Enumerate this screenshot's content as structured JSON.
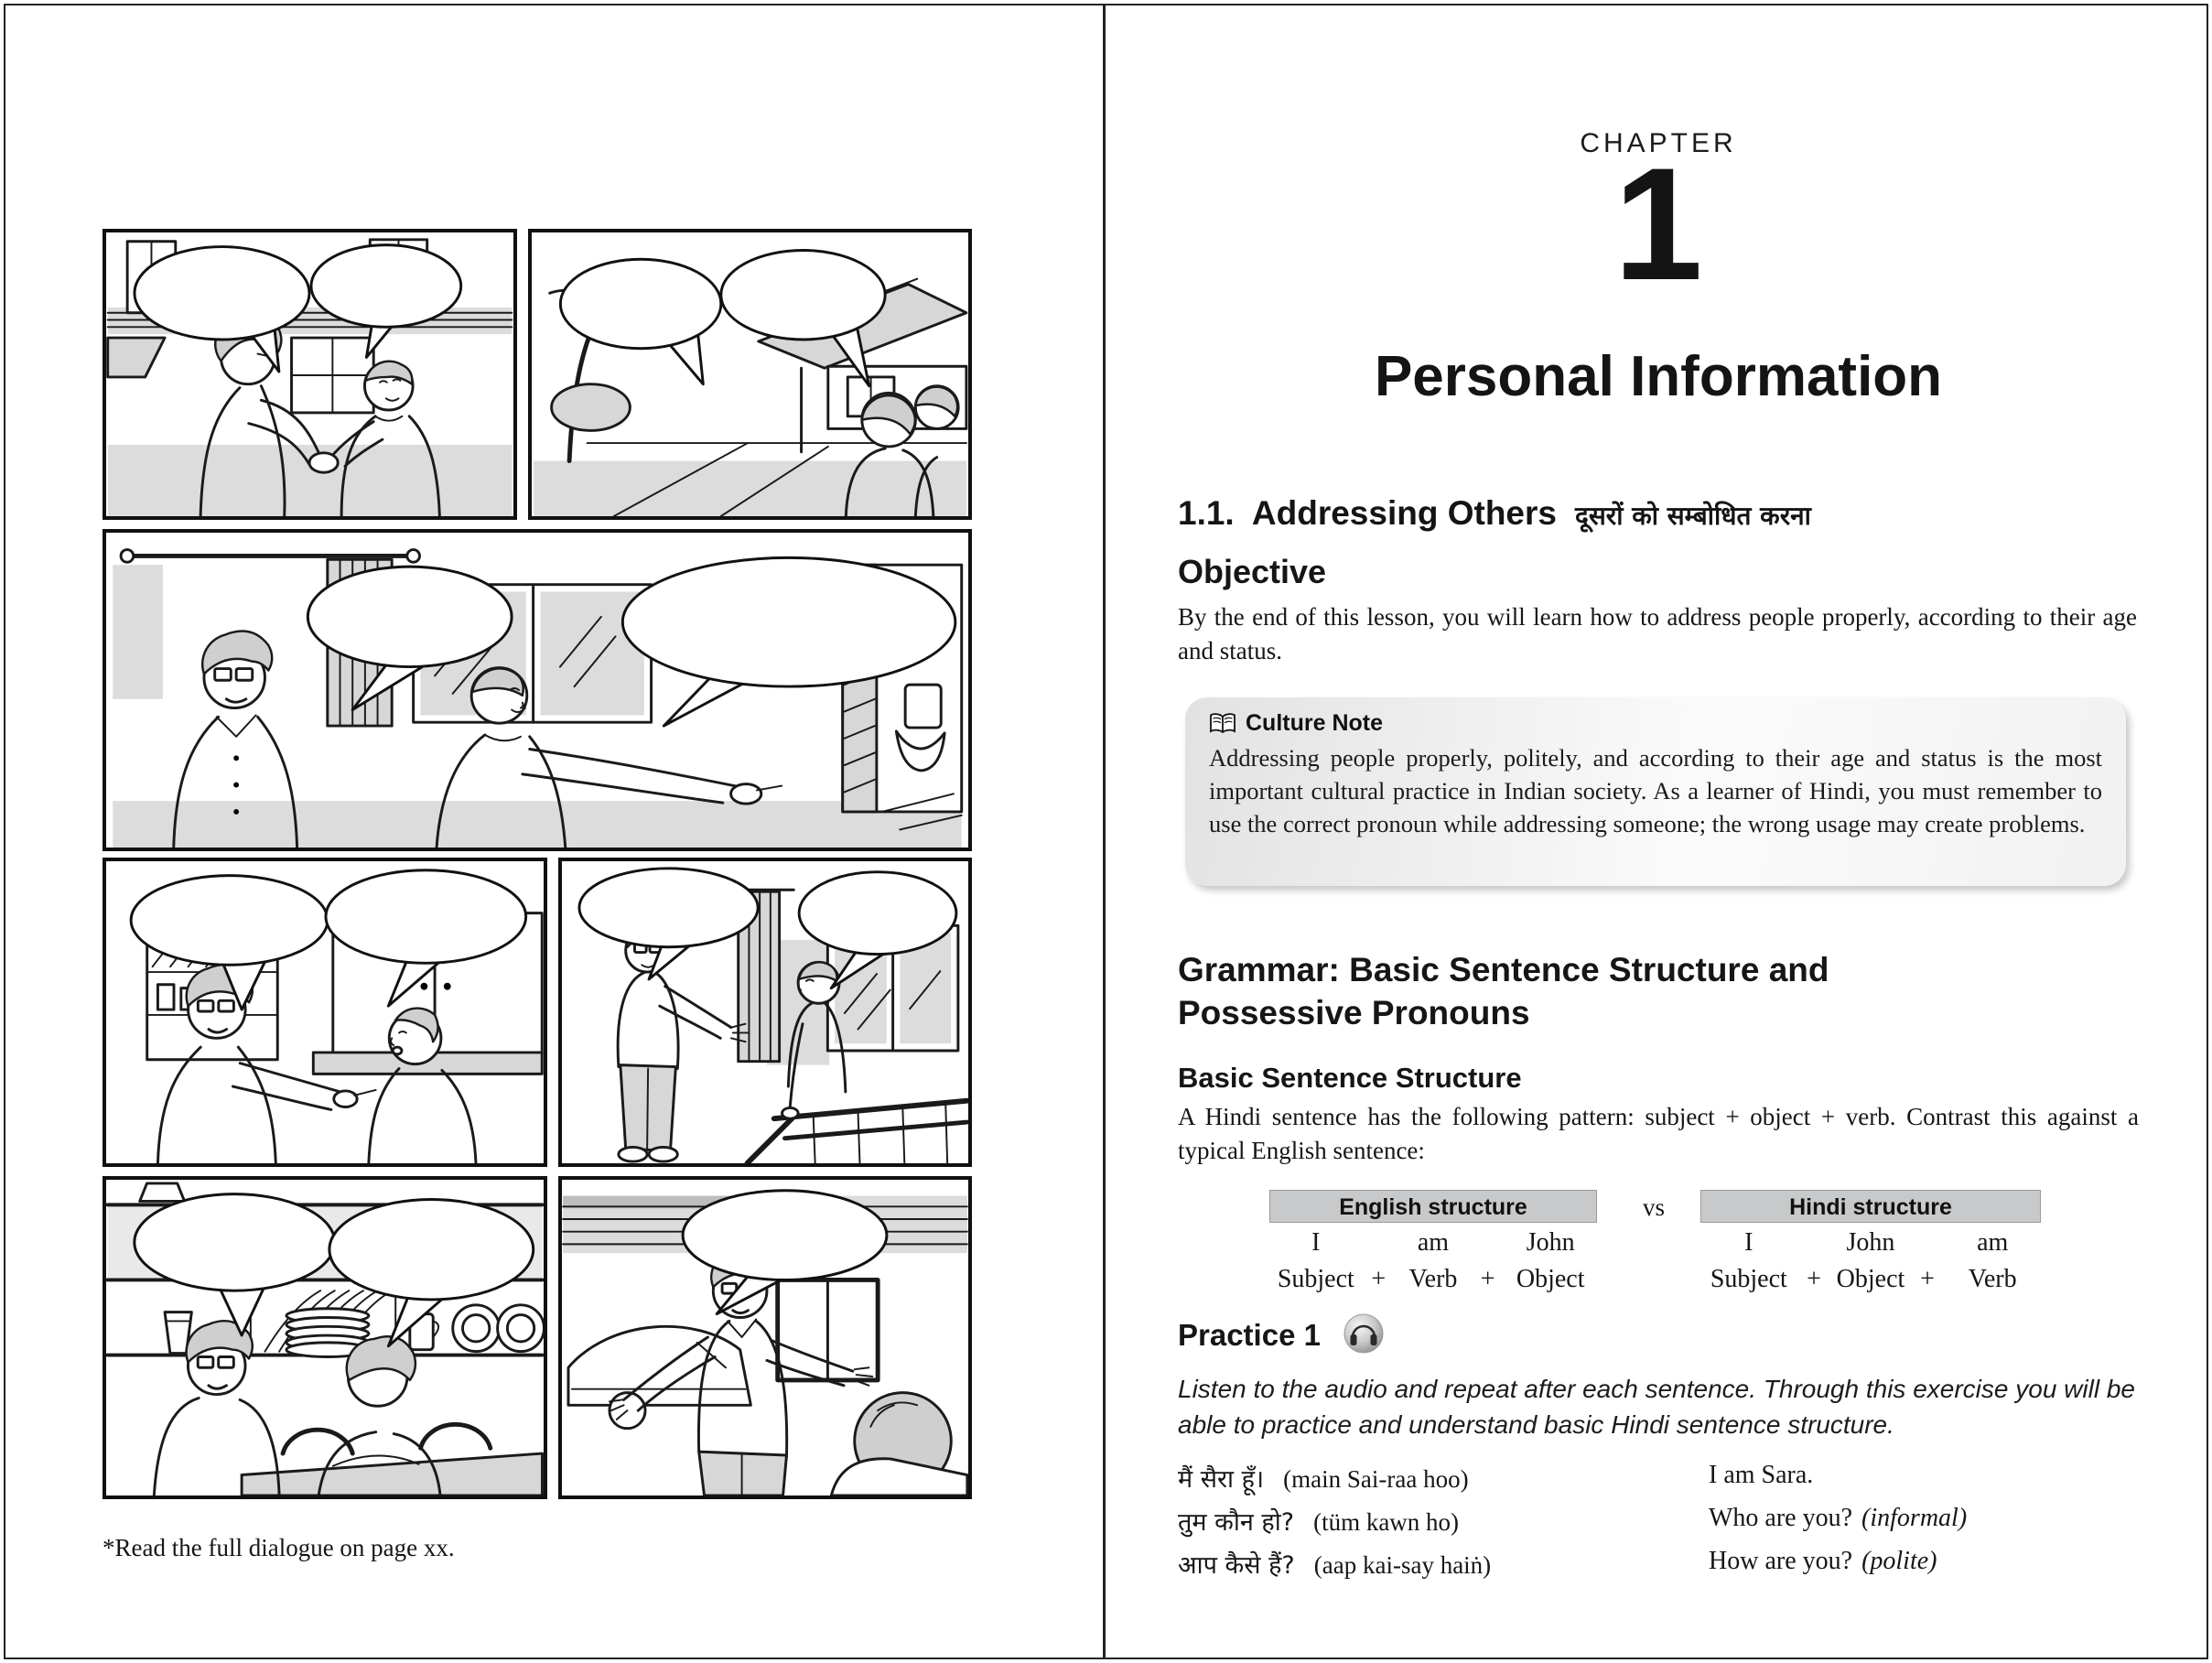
{
  "left": {
    "caption": "*Read the full dialogue on page xx.",
    "comic_panel_count": 7
  },
  "right": {
    "chapter_label": "CHAPTER",
    "chapter_number": "1",
    "chapter_title": "Personal Information",
    "section_heading": {
      "number": "1.1.",
      "title": "Addressing Others",
      "hindi": "दूसरों को सम्बोधित करना"
    },
    "objective": {
      "heading": "Objective",
      "body": "By the end of this lesson, you will learn how to address people properly, according to their age and status."
    },
    "culture_note": {
      "icon": "open-book-icon",
      "heading": "Culture Note",
      "body": "Addressing people properly, politely, and according to their age and status is the most important cultural practice in Indian society. As a learner of Hindi, you must remember to use the correct pronoun while addressing someone; the wrong usage may create problems."
    },
    "grammar": {
      "heading_line1": "Grammar: Basic Sentence Structure and",
      "heading_line2": "Possessive Pronouns",
      "subheading": "Basic Sentence Structure",
      "intro": "A Hindi sentence has the following pattern: subject + object + verb. Contrast this against a typical English sentence:"
    },
    "structure_table": {
      "vs_label": "vs",
      "english": {
        "header": "English structure",
        "words": [
          "I",
          "am",
          "John"
        ],
        "parts": [
          "Subject",
          "+",
          "Verb",
          "+",
          "Object"
        ]
      },
      "hindi": {
        "header": "Hindi structure",
        "words": [
          "I",
          "John",
          "am"
        ],
        "parts": [
          "Subject",
          "+",
          "Object",
          "+",
          "Verb"
        ]
      }
    },
    "practice": {
      "heading": "Practice 1",
      "audio_icon": "headphones-audio-icon",
      "instructions": "Listen to the audio and repeat after each sentence. Through this exercise you will be able to practice and understand basic Hindi sentence structure.",
      "rows": [
        {
          "hindi": "मैं सैरा हूँ।",
          "translit": "(main Sai-raa hoo)",
          "english": "I am Sara.",
          "note": ""
        },
        {
          "hindi": "तुम कौन हो?",
          "translit": "(tüm kawn ho)",
          "english": "Who are you?",
          "note": "(informal)"
        },
        {
          "hindi": "आप कैसे हैं?",
          "translit": "(aap kai-say haiṅ)",
          "english": "How are you?",
          "note": "(polite)"
        }
      ]
    }
  }
}
